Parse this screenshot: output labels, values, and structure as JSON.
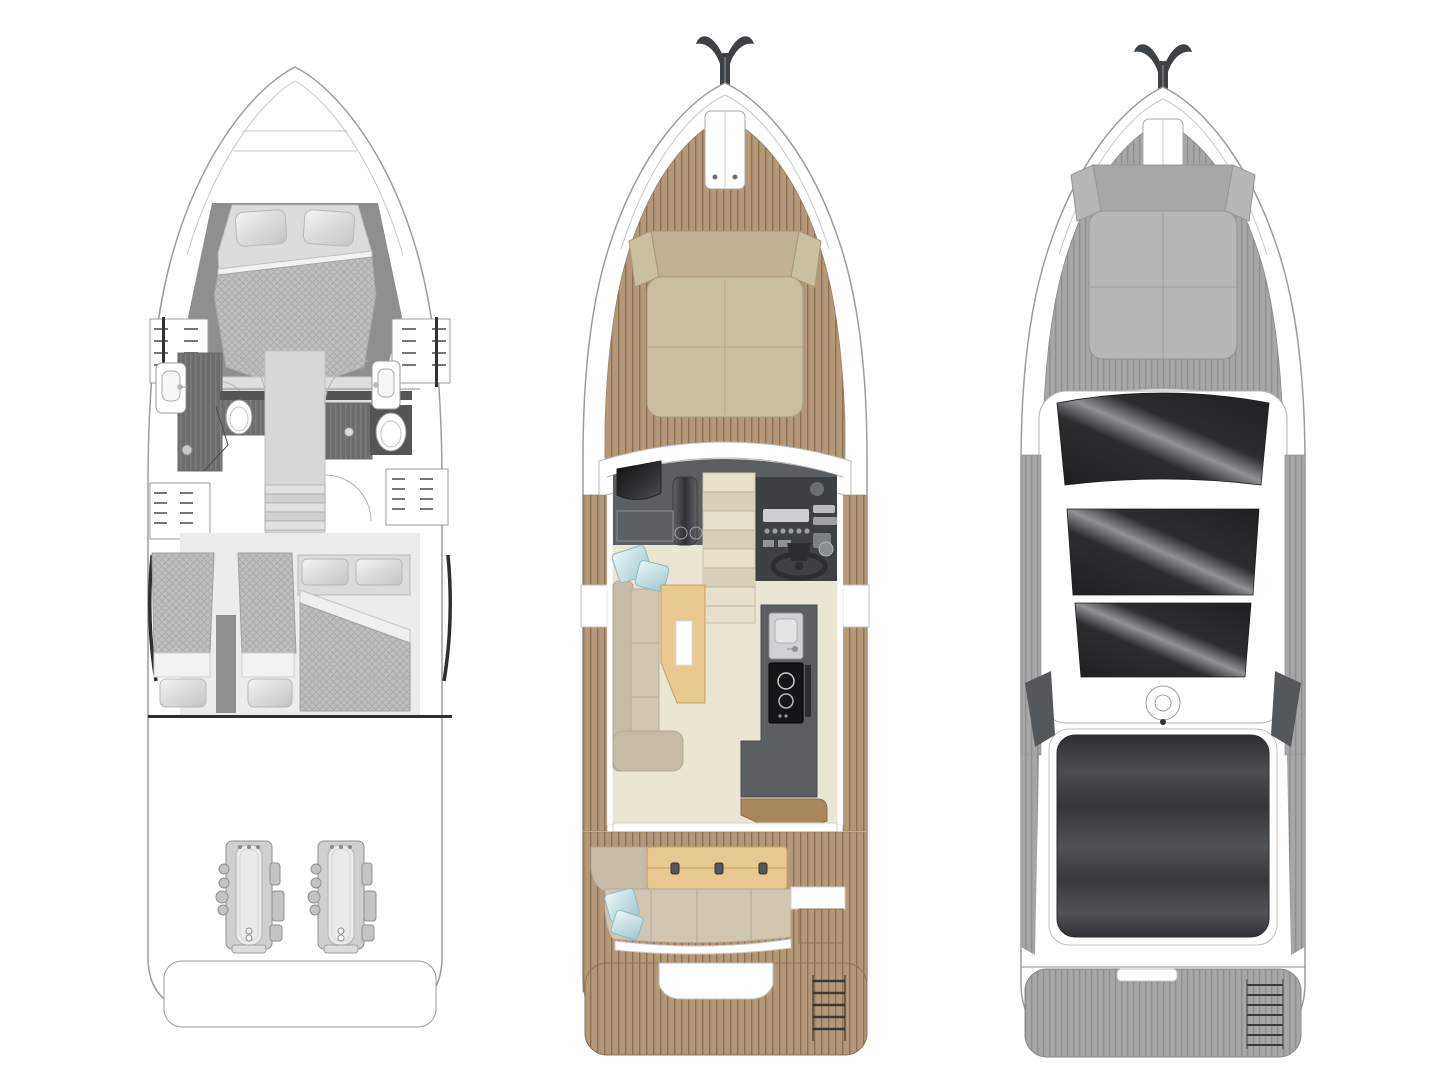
{
  "page": {
    "background": "#ffffff",
    "description": "Three-view motor yacht deck plan illustration, no visible text"
  },
  "colors": {
    "page-bg": "#ffffff",
    "hull-line": "#9c9c9c",
    "hull-line-light": "#c9c9c9",
    "teak": "#b39979",
    "teak-line": "#8c7153",
    "gray-deck": "#a6a6a6",
    "gray-deck-line": "#8e8e8e",
    "sunpad-beige": "#cbbfa2",
    "sunpad-beige-dark": "#bfb191",
    "sunpad-gray": "#b6b6b6",
    "sunpad-gray-dark": "#a7a7a7",
    "interior-dark": "#5c5f61",
    "helm-dark": "#3e4143",
    "panel-black": "#141516",
    "floor-cream": "#ebe5d4",
    "stair-light": "#e7e0cd",
    "stair-dark": "#d7cfba",
    "sofa-taupe": "#c6bba6",
    "sofa-taupe-light": "#d0c6b2",
    "table-wood": "#e7c88e",
    "table-wood-dark": "#d9b977",
    "cabinet-brown": "#a8875d",
    "pillow-blue": "#c2dde2",
    "pillow-blue-dark": "#9fc6cd",
    "glass-dark": "#1d1f20",
    "glass-highlight": "#8f9395",
    "canvas-dark": "#34363a",
    "mattress-gray": "#bfbfbf",
    "mattress-line": "#a9a9a9",
    "bed-plain": "#dcdcdc",
    "bath-floor": "#6d6d6d",
    "bath-floor-line": "#7d7d7d",
    "wall-gray": "#8f8f8f",
    "wall-dark": "#555555",
    "engine-body": "#cfcfcf",
    "engine-inner": "#eaeaea",
    "anchor-dark": "#3f4245"
  },
  "plans": [
    {
      "name": "lower-deck-plan",
      "position": "left",
      "style": "grayscale line drawing",
      "features": [
        "bow-double-berth",
        "two-pillows",
        "port-wardrobe",
        "starboard-wardrobe",
        "port-bathroom-sink",
        "port-toilet",
        "starboard-bathroom-sink",
        "starboard-toilet",
        "shower-drains",
        "companionway-stairs",
        "twin-guest-beds",
        "double-guest-bed",
        "hull-side-windows",
        "engine-room",
        "twin-engines",
        "transom-platform"
      ],
      "counts": {
        "bathrooms": 2,
        "engines": 2,
        "single-beds": 2,
        "double-beds": 2
      }
    },
    {
      "name": "main-deck-plan",
      "position": "center",
      "style": "colored with teak decking",
      "features": [
        "anchor",
        "anchor-locker",
        "bow-sunpad",
        "teak-side-decks",
        "windshield-frame",
        "dashboard",
        "tv-screen",
        "helm-instruments",
        "steering-wheel",
        "companionway-stairs",
        "galley-sink",
        "galley-stove",
        "l-shaped-sofa",
        "dining-table",
        "blue-deco-pillows",
        "aft-cabinet",
        "cockpit-bench",
        "cockpit-table",
        "teak-cockpit",
        "swim-platform",
        "bathing-ladder"
      ],
      "counts": {
        "stove-burners": 2,
        "table-hinges": 3,
        "stair-treads": 7,
        "blue-pillows": 4
      }
    },
    {
      "name": "exterior-top-plan",
      "position": "right",
      "style": "grayscale exterior view",
      "features": [
        "anchor",
        "anchor-locker",
        "bow-sunpad",
        "gray-side-decks",
        "windshield-glass",
        "hardtop",
        "front-sunroof-panel",
        "rear-sunroof-panel",
        "searchlight",
        "aft-canvas-top",
        "swim-platform",
        "bathing-ladder"
      ],
      "counts": {
        "glass-panels": 3,
        "ladder-rungs": 7
      }
    }
  ]
}
